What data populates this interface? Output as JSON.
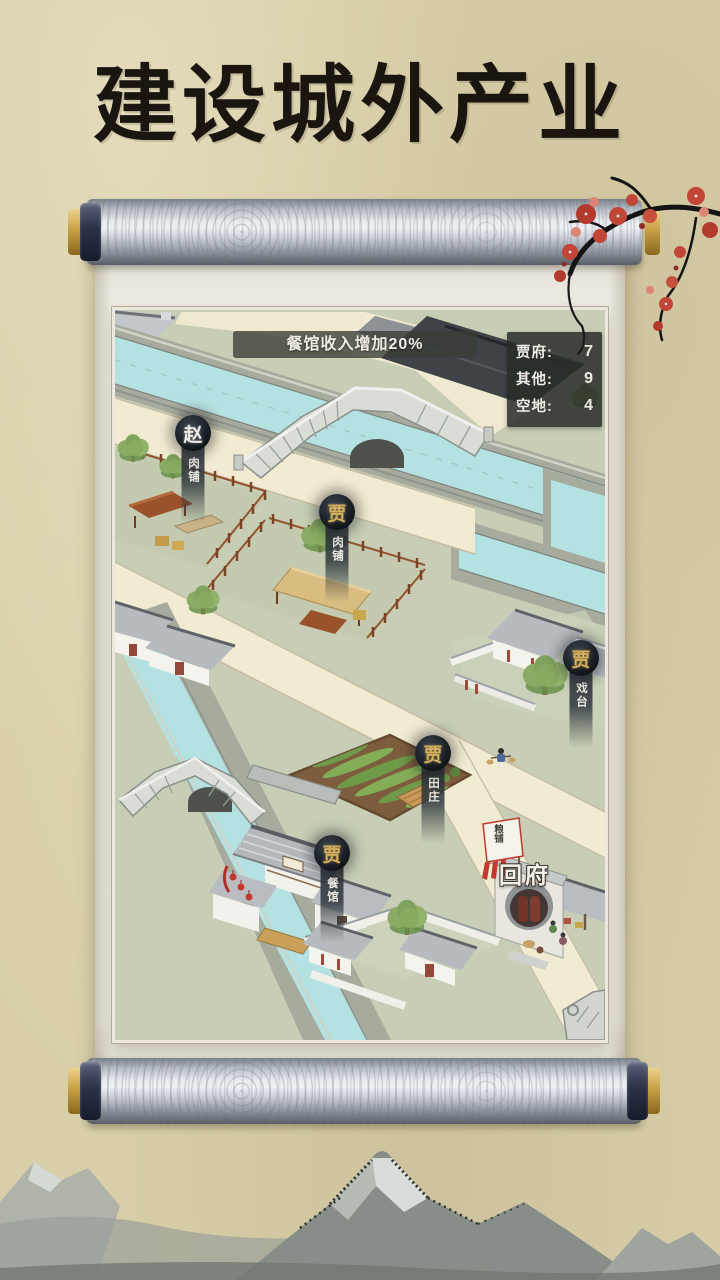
{
  "title": "建设城外产业",
  "map": {
    "event_banner": "餐馆收入增加20%",
    "stats": {
      "rows": [
        {
          "label": "贾府:",
          "value": "7"
        },
        {
          "label": "其他:",
          "value": "9"
        },
        {
          "label": "空地:",
          "value": "4"
        }
      ]
    },
    "markers": [
      {
        "owner": "赵",
        "shop": "肉铺"
      },
      {
        "owner": "贾",
        "shop": "肉铺"
      },
      {
        "owner": "贾",
        "shop": "田庄"
      },
      {
        "owner": "贾",
        "shop": "餐馆"
      },
      {
        "owner": "贾",
        "shop": "戏台"
      }
    ],
    "gate_button": "回府",
    "flag_label": "粮铺"
  },
  "colors": {
    "parchment": "#d8cfa9",
    "water": "#b4e1e1",
    "road": "#f1ebd1",
    "grass": "#c7ceb5",
    "marker_gold": "#d6b05c",
    "blossom_red": "#c24638",
    "panel_dark": "#282c28"
  }
}
